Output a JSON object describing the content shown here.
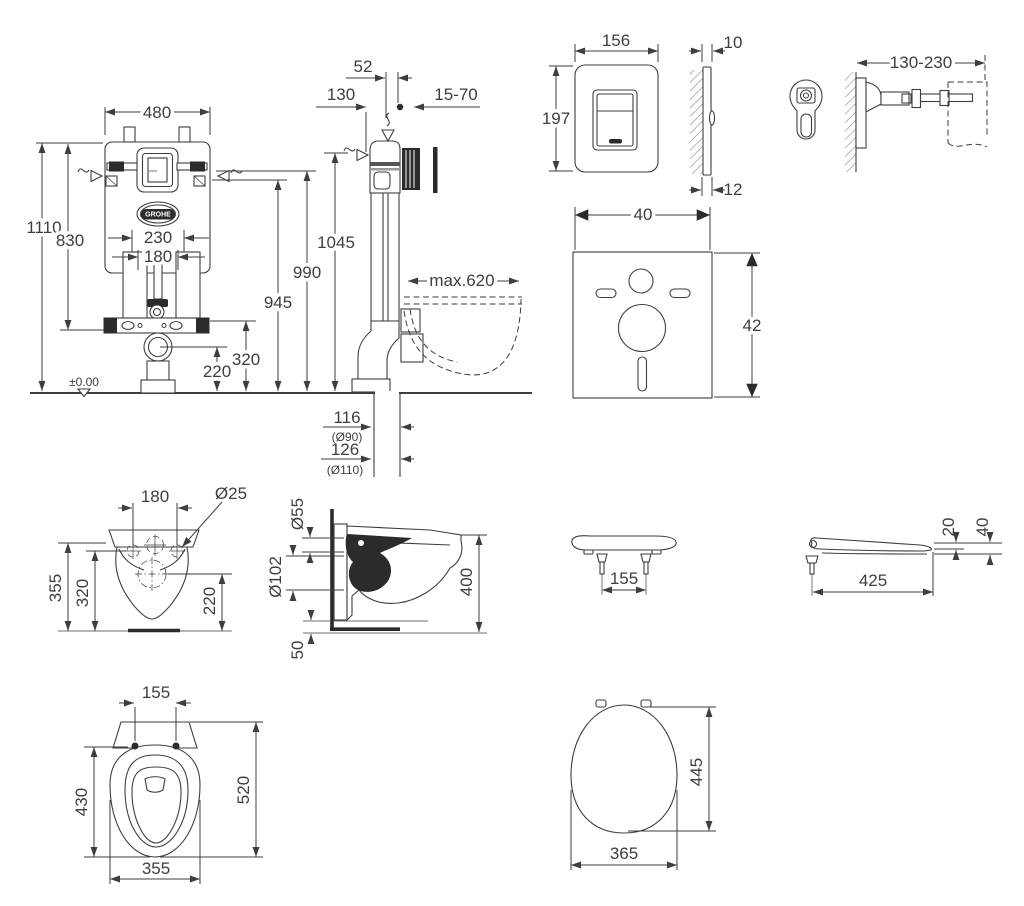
{
  "frame_front": {
    "width": "480",
    "height_total": "1110",
    "height_upper": "830",
    "rail_span": "230",
    "bolt_span": "180",
    "dim_990": "990",
    "dim_945": "945",
    "drain_height": "320",
    "outlet_height": "220",
    "datum": "±0.00",
    "brand": "GROHE"
  },
  "frame_side": {
    "offset_52": "52",
    "depth_130": "130",
    "wall_range": "15-70",
    "height_1045": "1045",
    "max_depth": "max.620",
    "outlet1": "116",
    "outlet1_dia": "(Ø90)",
    "outlet2": "126",
    "outlet2_dia": "(Ø110)"
  },
  "flush_plate": {
    "width": "156",
    "height": "197",
    "thickness_top": "10",
    "thickness_bottom": "12"
  },
  "wall_bracket": {
    "range": "130-230"
  },
  "sound_pad": {
    "width": "40",
    "height": "42"
  },
  "bowl_front": {
    "bolt_span": "180",
    "bolt_dia": "Ø25",
    "height_355": "355",
    "height_320": "320",
    "height_220": "220"
  },
  "bowl_side": {
    "inlet_dia": "Ø55",
    "outlet_dia": "Ø102",
    "height": "400",
    "bottom_gap": "50"
  },
  "seat_front": {
    "bolt_span": "155"
  },
  "seat_side": {
    "length": "425",
    "thickness_20": "20",
    "thickness_40": "40"
  },
  "bowl_top": {
    "bolt_span": "155",
    "depth_inner": "430",
    "depth": "520",
    "width": "355"
  },
  "seat_top": {
    "depth": "445",
    "width": "365"
  }
}
